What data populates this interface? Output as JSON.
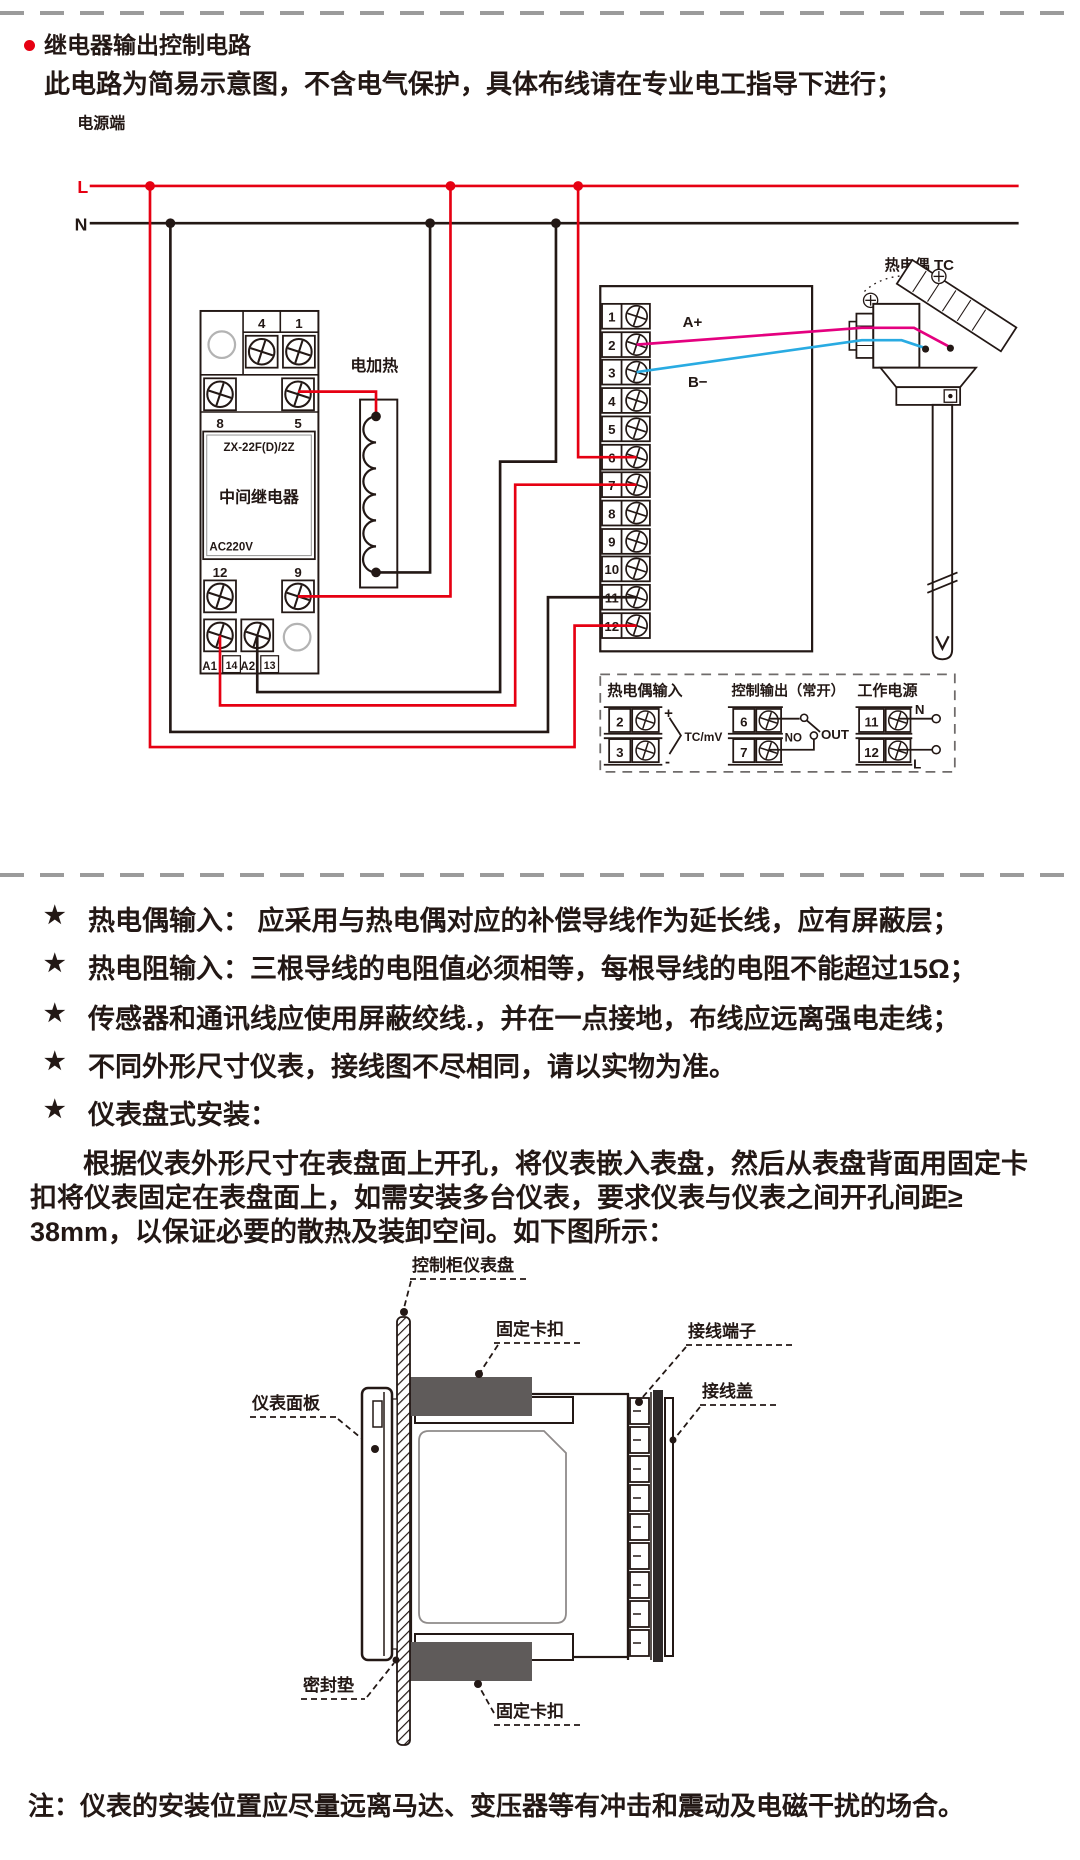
{
  "page": {
    "title": "继电器输出控制电路",
    "subtitle": "此电路为简易示意图，不含电气保护，具体布线请在专业电工指导下进行；",
    "footnote": "注：仪表的安装位置应尽量远离马达、变压器等有冲击和震动及电磁干扰的场合。",
    "bullet_glyph": "★"
  },
  "colors": {
    "accent_red": "#e60012",
    "wire_magenta": "#e4007f",
    "wire_cyan": "#29abe2",
    "line_black": "#231815",
    "clip_gray": "#5f5b5a"
  },
  "circuit": {
    "power_label": "电源端",
    "l": "L",
    "n": "N",
    "heater": "电加热",
    "thermocouple": "热电偶 TC",
    "a_plus": "A+",
    "b_minus": "B−",
    "relay": {
      "t4": "4",
      "t1": "1",
      "t8": "8",
      "t5": "5",
      "model": "ZX-22F(D)/2Z",
      "name": "中间继电器",
      "voltage": "AC220V",
      "t12": "12",
      "t9": "9",
      "a1": "A1",
      "t14": "14",
      "a2": "A2",
      "t13": "13"
    },
    "terminals": [
      "1",
      "2",
      "3",
      "4",
      "5",
      "6",
      "7",
      "8",
      "9",
      "10",
      "11",
      "12"
    ]
  },
  "legend": {
    "tc": {
      "title": "热电偶输入",
      "t2": "2",
      "t3": "3",
      "plus": "+",
      "minus": "-",
      "signal": "TC/mV"
    },
    "out": {
      "title": "控制输出（常开）",
      "t6": "6",
      "t7": "7",
      "no": "NO",
      "out": "OUT"
    },
    "power": {
      "title": "工作电源",
      "t11": "11",
      "t12": "12",
      "n": "N",
      "l": "L"
    }
  },
  "notes": [
    "热电偶输入： 应采用与热电偶对应的补偿导线作为延长线，应有屏蔽层；",
    "热电阻输入：三根导线的电阻值必须相等，每根导线的电阻不能超过15Ω；",
    "传感器和通讯线应使用屏蔽绞线.，并在一点接地，布线应远离强电走线；",
    "不同外形尺寸仪表，接线图不尽相同，请以实物为准。",
    "仪表盘式安装："
  ],
  "install": {
    "line1": "根据仪表外形尺寸在表盘面上开孔，将仪表嵌入表盘，然后从表盘背面用固定卡",
    "line2": "扣将仪表固定在表盘面上，如需安装多台仪表，要求仪表与仪表之间开孔间距≥",
    "line3": "38mm，以保证必要的散热及装卸空间。如下图所示："
  },
  "mount": {
    "panel_board": "控制柜仪表盘",
    "clip_top": "固定卡扣",
    "terminal_block": "接线端子",
    "terminal_cover": "接线盖",
    "front_panel": "仪表面板",
    "gasket": "密封垫",
    "clip_bottom": "固定卡扣"
  }
}
